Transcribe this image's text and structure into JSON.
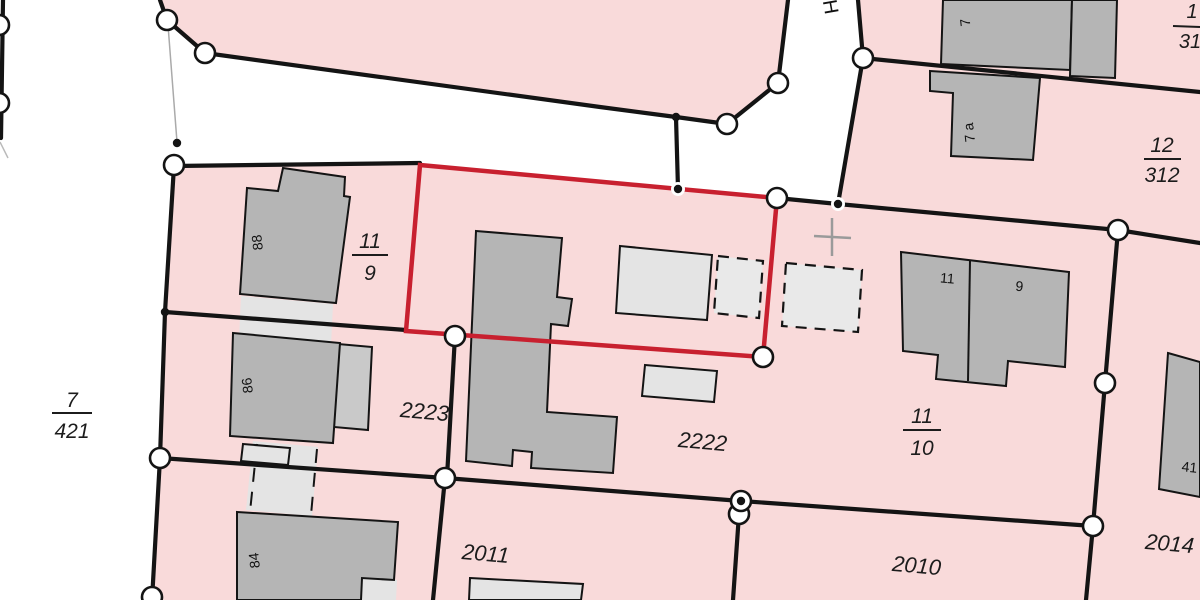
{
  "map": {
    "street_label_partial": "H",
    "colors": {
      "parcel_fill": "#f9dada",
      "selection_red": "#c8202f",
      "building_dark": "#b5b5b5",
      "building_light": "#e4e4e4",
      "building_annex": "#c9c9c9",
      "boundary_line": "#141414",
      "node_fill": "#ffffff",
      "survey_cross": "#9a9a9a"
    },
    "parcel_labels": {
      "p2223": "2223",
      "p2222": "2222",
      "p2011": "2011",
      "p2010": "2010",
      "p2014": "2014"
    },
    "fractions": {
      "f7_421": {
        "num": "7",
        "den": "421"
      },
      "f11_9": {
        "num": "11",
        "den": "9"
      },
      "f11_10": {
        "num": "11",
        "den": "10"
      },
      "f12_312": {
        "num": "12",
        "den": "312"
      },
      "f_corner": {
        "num": "1",
        "den": "31"
      }
    },
    "house_numbers": {
      "h88": "88",
      "h86": "86",
      "h84": "84",
      "h11": "11",
      "h9": "9",
      "h7": "7",
      "h7a": "7 a",
      "h41": "41"
    }
  }
}
